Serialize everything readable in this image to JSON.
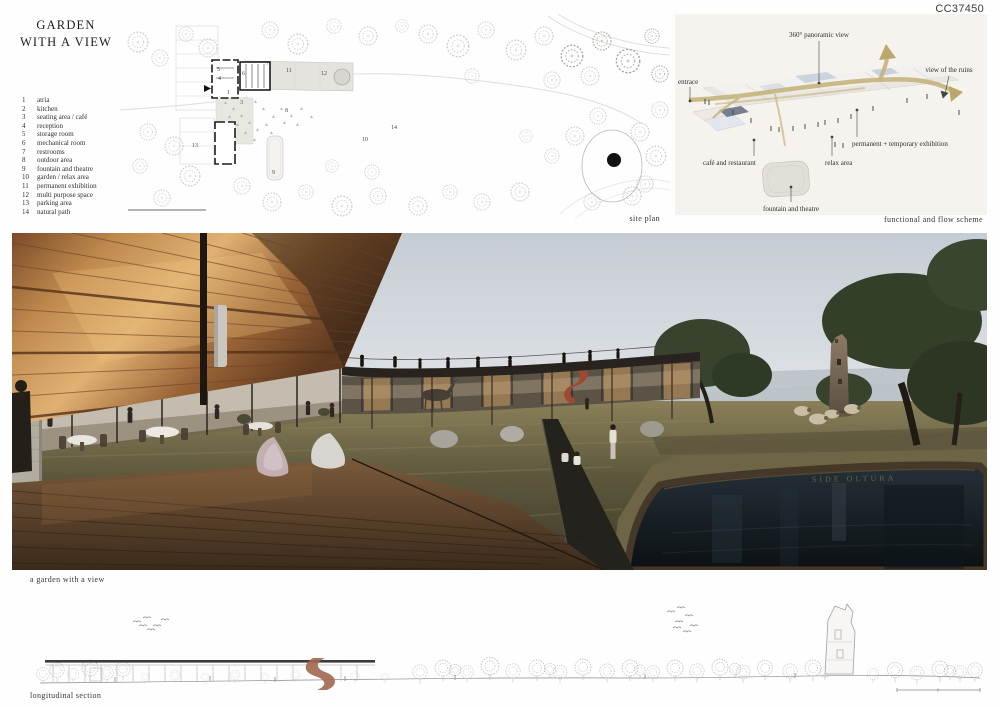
{
  "board": {
    "code": "CC37450",
    "title_line1": "GARDEN",
    "title_line2": "WITH A VIEW"
  },
  "legend": {
    "items": [
      {
        "num": "1",
        "label": "atria"
      },
      {
        "num": "2",
        "label": "kitchen"
      },
      {
        "num": "3",
        "label": "seating area / café"
      },
      {
        "num": "4",
        "label": "reception"
      },
      {
        "num": "5",
        "label": "storage room"
      },
      {
        "num": "6",
        "label": "mechanical room"
      },
      {
        "num": "7",
        "label": "restrooms"
      },
      {
        "num": "8",
        "label": "outdoor area"
      },
      {
        "num": "9",
        "label": "fountain and theatre"
      },
      {
        "num": "10",
        "label": "garden / relax area"
      },
      {
        "num": "11",
        "label": "permanent exhibition"
      },
      {
        "num": "12",
        "label": "multi purpose space"
      },
      {
        "num": "13",
        "label": "parking area"
      },
      {
        "num": "14",
        "label": "natural path"
      }
    ]
  },
  "site_plan": {
    "caption": "site plan",
    "numbers": {
      "n1": "1",
      "n3": "3",
      "n4": "4",
      "n5": "5",
      "n6": "6",
      "n7": "7",
      "n8": "8",
      "n9": "9",
      "n10": "10",
      "n11": "11",
      "n12": "12",
      "n13": "13",
      "n14": "14"
    }
  },
  "scheme": {
    "caption": "functional and flow scheme",
    "labels": {
      "panoramic": "360° panoramic view",
      "ruins": "view of  the ruins",
      "entrance": "entrace",
      "cafe": "café and restaurant",
      "relax": "relax area",
      "exhibition": "permanent + temporary exhibition",
      "fountain": "fountain and theatre"
    }
  },
  "render": {
    "caption": "a garden with a view",
    "pool_inscription": "SIDE OLTURA"
  },
  "section": {
    "caption": "longitudinal section"
  },
  "colors": {
    "flow_arrow": "#c5b47c",
    "wood": "#c08e53",
    "corten": "#8a4b32",
    "pool_water": "#12181c",
    "stair_accent": "#9c4a35"
  }
}
